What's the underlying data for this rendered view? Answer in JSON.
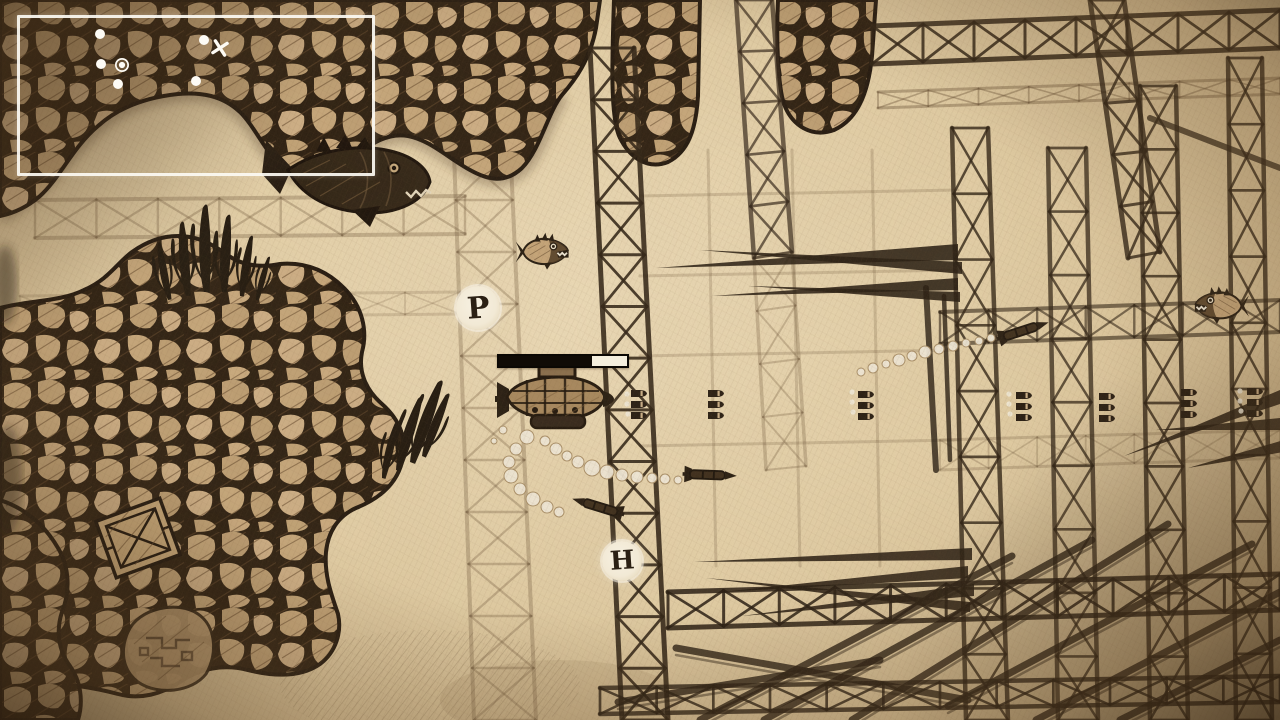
{
  "scene_description": "hand-drawn sepia underwater side-scrolling shooter frame",
  "hud": {
    "minimap": {
      "x": 17,
      "y": 15,
      "width": 352,
      "height": 155,
      "markers": [
        {
          "type": "dot",
          "x": 80,
          "y": 16
        },
        {
          "type": "dot",
          "x": 184,
          "y": 22
        },
        {
          "type": "cross",
          "x": 200,
          "y": 30
        },
        {
          "type": "dot",
          "x": 81,
          "y": 46
        },
        {
          "type": "ring",
          "x": 102,
          "y": 47
        },
        {
          "type": "dot",
          "x": 98,
          "y": 66
        },
        {
          "type": "dot",
          "x": 176,
          "y": 63
        }
      ]
    },
    "health_bar": {
      "x": 497,
      "y": 354,
      "width": 128,
      "height": 10,
      "fill_ratio": 0.73
    }
  },
  "pickups": {
    "p": {
      "label": "P",
      "x": 478,
      "y": 308,
      "diameter": 44,
      "font_size": 30
    },
    "h": {
      "label": "H",
      "x": 622,
      "y": 561,
      "diameter": 40,
      "font_size": 26
    }
  },
  "world": {
    "player": {
      "type": "submarine",
      "x": 553,
      "y": 399,
      "facing": "right"
    },
    "enemies": [
      {
        "type": "mech-shark",
        "x": 350,
        "y": 178,
        "facing": "right",
        "scale": 1.0
      },
      {
        "type": "piranha",
        "x": 547,
        "y": 252,
        "facing": "right",
        "scale": 0.8
      },
      {
        "type": "piranha",
        "x": 1217,
        "y": 306,
        "facing": "left",
        "scale": 0.82
      }
    ],
    "missiles": [
      {
        "x": 712,
        "y": 475,
        "angle": 2
      },
      {
        "x": 596,
        "y": 506,
        "angle": 197
      },
      {
        "x": 1025,
        "y": 330,
        "angle": -18
      }
    ],
    "bullet_volleys": [
      {
        "x": 631,
        "y": 390
      },
      {
        "x": 708,
        "y": 390
      },
      {
        "x": 858,
        "y": 391
      },
      {
        "x": 1016,
        "y": 392
      },
      {
        "x": 1099,
        "y": 393
      },
      {
        "x": 1181,
        "y": 389
      },
      {
        "x": 1247,
        "y": 388
      }
    ],
    "bubbles": [
      [
        527,
        437,
        7
      ],
      [
        516,
        449,
        6
      ],
      [
        509,
        462,
        6
      ],
      [
        511,
        476,
        7
      ],
      [
        520,
        489,
        6
      ],
      [
        533,
        499,
        7
      ],
      [
        547,
        507,
        6
      ],
      [
        559,
        512,
        5
      ],
      [
        545,
        441,
        5
      ],
      [
        556,
        449,
        6
      ],
      [
        567,
        456,
        5
      ],
      [
        503,
        430,
        4
      ],
      [
        494,
        441,
        3
      ],
      [
        578,
        462,
        6
      ],
      [
        592,
        468,
        8
      ],
      [
        607,
        472,
        7
      ],
      [
        622,
        475,
        6
      ],
      [
        637,
        477,
        6
      ],
      [
        652,
        478,
        5
      ],
      [
        665,
        479,
        5
      ],
      [
        678,
        480,
        4
      ],
      [
        861,
        372,
        4
      ],
      [
        873,
        368,
        5
      ],
      [
        886,
        364,
        4
      ],
      [
        899,
        360,
        6
      ],
      [
        912,
        356,
        5
      ],
      [
        925,
        352,
        6
      ],
      [
        939,
        349,
        5
      ],
      [
        953,
        346,
        5
      ],
      [
        966,
        343,
        4
      ],
      [
        979,
        341,
        4
      ],
      [
        991,
        338,
        4
      ]
    ],
    "bubble_dots": [
      [
        627,
        394
      ],
      [
        627,
        404
      ],
      [
        628,
        414
      ],
      [
        852,
        392
      ],
      [
        852,
        402
      ],
      [
        853,
        412
      ],
      [
        1009,
        394
      ],
      [
        1009,
        404
      ],
      [
        1010,
        414
      ],
      [
        1240,
        391
      ],
      [
        1240,
        401
      ],
      [
        1241,
        411
      ]
    ],
    "props": [
      {
        "type": "crate",
        "x": 138,
        "y": 538,
        "angle": -20
      },
      {
        "type": "circuit-rock",
        "x": 168,
        "y": 650
      }
    ]
  },
  "colors": {
    "paper": "#e6d2ab",
    "ink": "#2c2013",
    "ink_faded": "#6a5338",
    "stone": "#c7a87c",
    "sprite_white": "#f5efe0",
    "bar_fill": "#100b06"
  }
}
